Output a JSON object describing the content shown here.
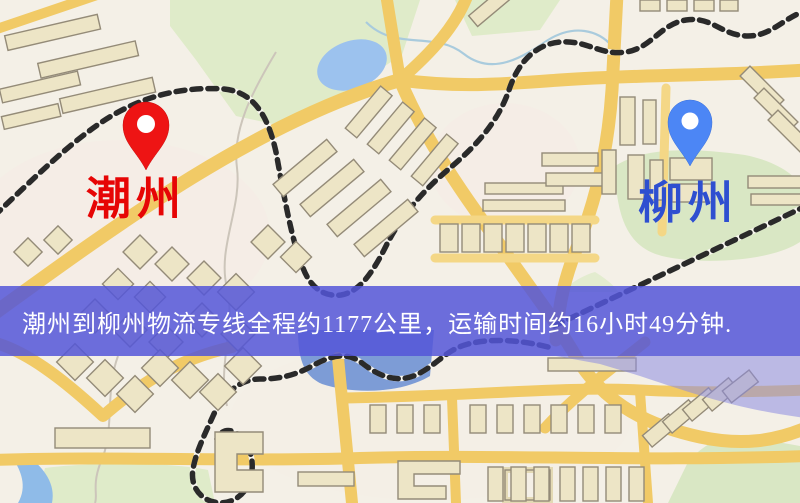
{
  "image_type": "logistics-route-map",
  "pins": {
    "origin": {
      "name": "潮州",
      "color": "#EE1414",
      "label_color": "#E60505"
    },
    "destination": {
      "name": "柳州",
      "color": "#4C86F5",
      "label_color": "#2E4FD0"
    }
  },
  "caption": {
    "text": "潮州到柳州物流专线全程约1177公里，运输时间约16小时49分钟.",
    "background_color": "#5456D8",
    "text_color": "#FFFFFF"
  },
  "palette": {
    "map_background": "#F4F0E7",
    "road_yellow": "#F1CA66",
    "park_green": "#DFEBC9",
    "water_blue": "#9CC2EE",
    "building_beige": "#EDE5C6",
    "railway_dark": "#2A2A2A",
    "river_overlay_violet": "#8D8DE2"
  }
}
